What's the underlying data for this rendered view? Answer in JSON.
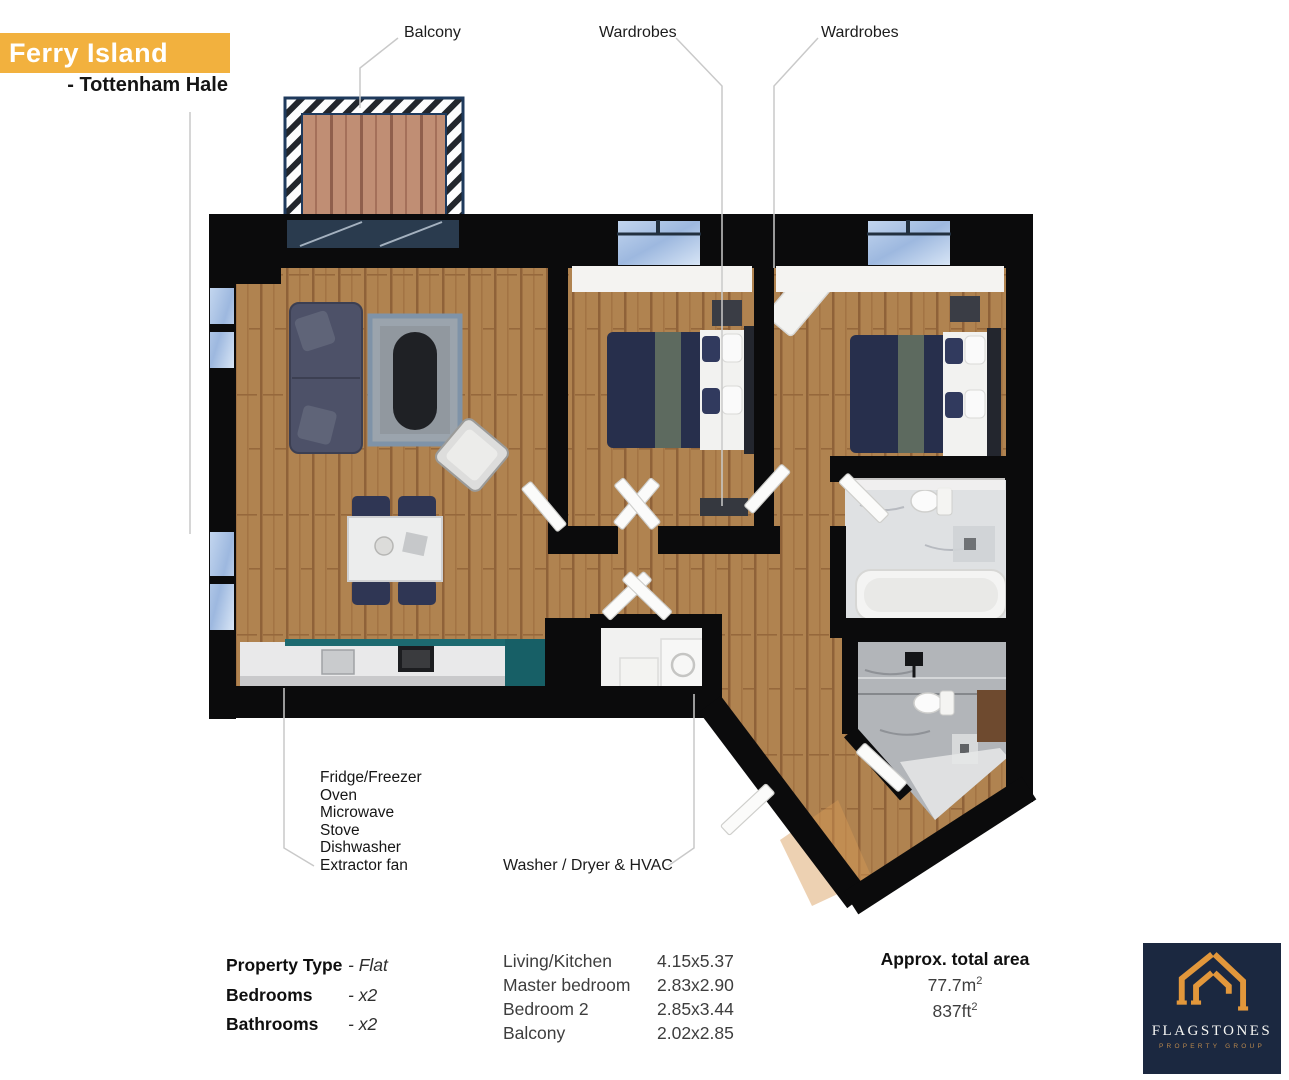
{
  "header": {
    "development_name": "Ferry Island",
    "location": "- Tottenham Hale",
    "banner_color": "#F2B13E"
  },
  "plan_labels": {
    "balcony": "Balcony",
    "wardrobes_1": "Wardrobes",
    "wardrobes_2": "Wardrobes",
    "kitchen_appliances": [
      "Fridge/Freezer",
      "Oven",
      "Microwave",
      "Stove",
      "Dishwasher",
      "Extractor fan"
    ],
    "utility": "Washer / Dryer & HVAC"
  },
  "property_details": {
    "rows": [
      {
        "label": "Property Type",
        "value": "- Flat"
      },
      {
        "label": "Bedrooms",
        "value": "- x2"
      },
      {
        "label": "Bathrooms",
        "value": "- x2"
      }
    ]
  },
  "room_dimensions": {
    "rows": [
      {
        "room": "Living/Kitchen",
        "size": "4.15x5.37"
      },
      {
        "room": "Master bedroom",
        "size": "2.83x2.90"
      },
      {
        "room": "Bedroom 2",
        "size": "2.85x3.44"
      },
      {
        "room": "Balcony",
        "size": "2.02x2.85"
      }
    ]
  },
  "total_area": {
    "title": "Approx. total area",
    "metric_value": "77.7m",
    "metric_sup": "2",
    "imperial_value": "837ft",
    "imperial_sup": "2"
  },
  "logo": {
    "name": "FLAGSTONES",
    "tagline": "PROPERTY GROUP",
    "background": "#1b2840",
    "gold": "#E2973B"
  },
  "palette": {
    "wall": "#0b0b0c",
    "wood_floor": "#b08350",
    "balcony_deck": "#c08e74",
    "window_glass": "#a9c3e6",
    "kitchen_teal": "#1d6a70",
    "furniture_navy": "#2a3150",
    "leader_line": "#c9c9c9"
  }
}
